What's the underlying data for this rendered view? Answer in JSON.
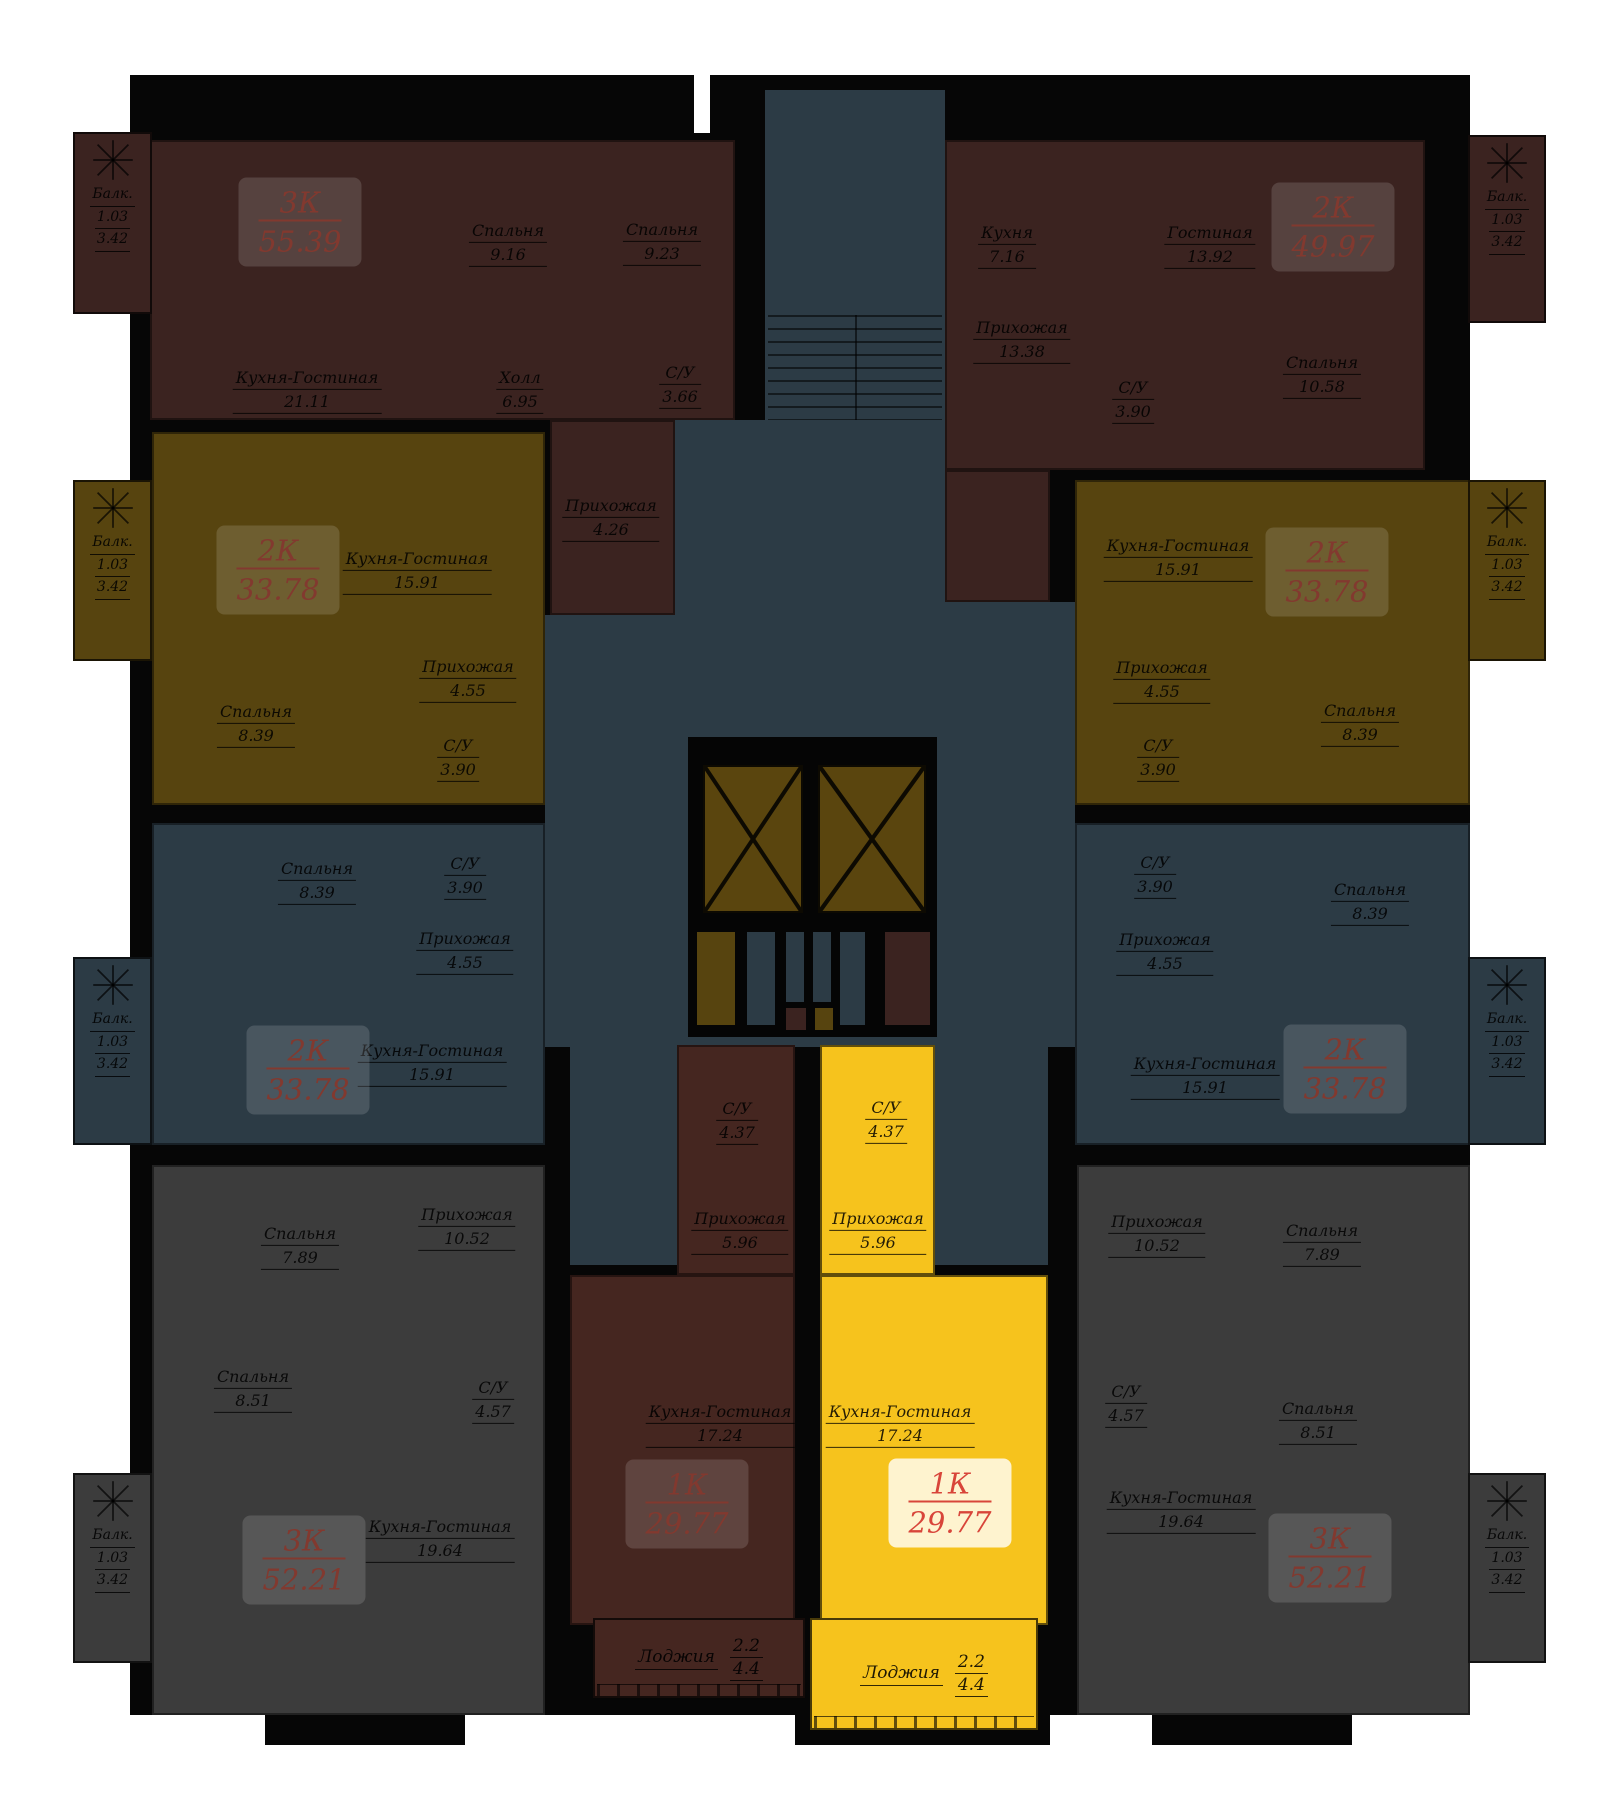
{
  "plan_type": "residential-floor-plan",
  "colors": {
    "wall": "#060606",
    "apartment_maroon": "#3b2320",
    "apartment_olive": "#57440f",
    "apartment_blue_gray": "#2c3b45",
    "apartment_gray": "#3c3c3c",
    "apartment_selected_yellow": "#f6c31d",
    "badge_text_dark": "#82392f",
    "badge_text_selected": "#d8453a"
  },
  "selection": {
    "selected_type": "1К",
    "selected_area": "29.77",
    "highlight_color": "#f6c31d"
  },
  "apartments": [
    {
      "id": "3k-top-left",
      "type_label": "3К",
      "total_area": "55.39",
      "highlighted": false,
      "rooms": [
        {
          "name": "Кухня-Гостиная",
          "area": "21.11"
        },
        {
          "name": "Спальня",
          "area": "9.16"
        },
        {
          "name": "Спальня",
          "area": "9.23"
        },
        {
          "name": "Холл",
          "area": "6.95"
        },
        {
          "name": "С/У",
          "area": "3.66"
        },
        {
          "name": "Прихожая",
          "area": "4.26"
        }
      ],
      "balcony": {
        "label": "Балк.",
        "area_reduced": "1.03",
        "area_full": "3.42"
      }
    },
    {
      "id": "2k-top-right",
      "type_label": "2К",
      "total_area": "49.97",
      "highlighted": false,
      "rooms": [
        {
          "name": "Кухня",
          "area": "7.16"
        },
        {
          "name": "Гостиная",
          "area": "13.92"
        },
        {
          "name": "Прихожая",
          "area": "13.38"
        },
        {
          "name": "С/У",
          "area": "3.90"
        },
        {
          "name": "Спальня",
          "area": "10.58"
        }
      ],
      "balcony": {
        "label": "Балк.",
        "area_reduced": "1.03",
        "area_full": "3.42"
      }
    },
    {
      "id": "2k-mid-left",
      "type_label": "2К",
      "total_area": "33.78",
      "highlighted": false,
      "rooms": [
        {
          "name": "Кухня-Гостиная",
          "area": "15.91"
        },
        {
          "name": "Прихожая",
          "area": "4.55"
        },
        {
          "name": "Спальня",
          "area": "8.39"
        },
        {
          "name": "С/У",
          "area": "3.90"
        }
      ],
      "balcony": {
        "label": "Балк.",
        "area_reduced": "1.03",
        "area_full": "3.42"
      }
    },
    {
      "id": "2k-mid-right",
      "type_label": "2К",
      "total_area": "33.78",
      "highlighted": false,
      "rooms": [
        {
          "name": "Кухня-Гостиная",
          "area": "15.91"
        },
        {
          "name": "Прихожая",
          "area": "4.55"
        },
        {
          "name": "Спальня",
          "area": "8.39"
        },
        {
          "name": "С/У",
          "area": "3.90"
        }
      ],
      "balcony": {
        "label": "Балк.",
        "area_reduced": "1.03",
        "area_full": "3.42"
      }
    },
    {
      "id": "2k-lower-left",
      "type_label": "2К",
      "total_area": "33.78",
      "highlighted": false,
      "rooms": [
        {
          "name": "Спальня",
          "area": "8.39"
        },
        {
          "name": "С/У",
          "area": "3.90"
        },
        {
          "name": "Прихожая",
          "area": "4.55"
        },
        {
          "name": "Кухня-Гостиная",
          "area": "15.91"
        }
      ],
      "balcony": {
        "label": "Балк.",
        "area_reduced": "1.03",
        "area_full": "3.42"
      }
    },
    {
      "id": "2k-lower-right",
      "type_label": "2К",
      "total_area": "33.78",
      "highlighted": false,
      "rooms": [
        {
          "name": "Спальня",
          "area": "8.39"
        },
        {
          "name": "С/У",
          "area": "3.90"
        },
        {
          "name": "Прихожая",
          "area": "4.55"
        },
        {
          "name": "Кухня-Гостиная",
          "area": "15.91"
        }
      ],
      "balcony": {
        "label": "Балк.",
        "area_reduced": "1.03",
        "area_full": "3.42"
      }
    },
    {
      "id": "3k-bottom-left",
      "type_label": "3К",
      "total_area": "52.21",
      "highlighted": false,
      "rooms": [
        {
          "name": "Спальня",
          "area": "7.89"
        },
        {
          "name": "Прихожая",
          "area": "10.52"
        },
        {
          "name": "Спальня",
          "area": "8.51"
        },
        {
          "name": "С/У",
          "area": "4.57"
        },
        {
          "name": "Кухня-Гостиная",
          "area": "19.64"
        }
      ],
      "balcony": {
        "label": "Балк.",
        "area_reduced": "1.03",
        "area_full": "3.42"
      }
    },
    {
      "id": "3k-bottom-right",
      "type_label": "3К",
      "total_area": "52.21",
      "highlighted": false,
      "rooms": [
        {
          "name": "Спальня",
          "area": "7.89"
        },
        {
          "name": "Прихожая",
          "area": "10.52"
        },
        {
          "name": "Спальня",
          "area": "8.51"
        },
        {
          "name": "С/У",
          "area": "4.57"
        },
        {
          "name": "Кухня-Гостиная",
          "area": "19.64"
        }
      ],
      "balcony": {
        "label": "Балк.",
        "area_reduced": "1.03",
        "area_full": "3.42"
      }
    },
    {
      "id": "1k-center-left",
      "type_label": "1К",
      "total_area": "29.77",
      "highlighted": false,
      "rooms": [
        {
          "name": "С/У",
          "area": "4.37"
        },
        {
          "name": "Прихожая",
          "area": "5.96"
        },
        {
          "name": "Кухня-Гостиная",
          "area": "17.24"
        }
      ],
      "loggia": {
        "label": "Лоджия",
        "area_reduced": "2.2",
        "area_full": "4.4"
      }
    },
    {
      "id": "1k-center-right",
      "type_label": "1К",
      "total_area": "29.77",
      "highlighted": true,
      "rooms": [
        {
          "name": "С/У",
          "area": "4.37"
        },
        {
          "name": "Прихожая",
          "area": "5.96"
        },
        {
          "name": "Кухня-Гостиная",
          "area": "17.24"
        }
      ],
      "loggia": {
        "label": "Лоджия",
        "area_reduced": "2.2",
        "area_full": "4.4"
      }
    }
  ]
}
